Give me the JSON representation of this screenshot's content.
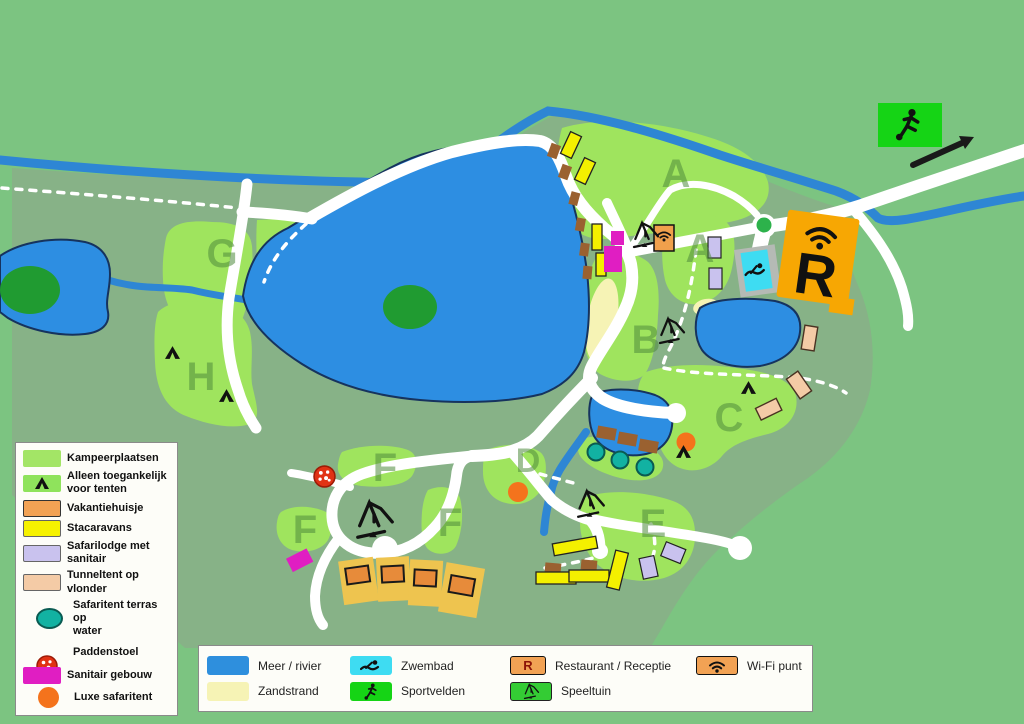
{
  "map": {
    "area_labels": [
      "G",
      "H",
      "A",
      "A",
      "B",
      "C",
      "D",
      "E",
      "F",
      "F",
      "F"
    ],
    "restaurant_label": "R"
  },
  "legend_left": {
    "items": [
      {
        "label": "Kampeerplaatsen",
        "swatch": "camp-green"
      },
      {
        "label": "Alleen toegankelijk\nvoor tenten",
        "swatch": "green-tent-icon"
      },
      {
        "label": "Vakantiehuisje",
        "swatch": "orange"
      },
      {
        "label": "Stacaravans",
        "swatch": "yellow"
      },
      {
        "label": "Safarilodge met\nsanitair",
        "swatch": "lavender"
      },
      {
        "label": "Tunneltent op vlonder",
        "swatch": "salmon"
      },
      {
        "label": "Safaritent terras op\nwater",
        "swatch": "teal-ellipse"
      },
      {
        "label": "Paddenstoel",
        "swatch": "red-dotted-circle"
      },
      {
        "label": "Sanitair gebouw",
        "swatch": "magenta"
      },
      {
        "label": "Luxe safaritent",
        "swatch": "orange-circle"
      }
    ]
  },
  "legend_bottom": {
    "restaurant_letter": "R",
    "items": [
      {
        "label": "Meer / rivier",
        "swatch": "blue"
      },
      {
        "label": "Zwembad",
        "swatch": "cyan-swimmer-icon"
      },
      {
        "label": "Restaurant / Receptie",
        "swatch": "orange-R"
      },
      {
        "label": "Wi-Fi punt",
        "swatch": "orange-wifi-icon"
      },
      {
        "label": "Zandstrand",
        "swatch": "pale-yellow"
      },
      {
        "label": "Sportvelden",
        "swatch": "green-soccer-icon"
      },
      {
        "label": "Speeltuin",
        "swatch": "green-playground-icon"
      }
    ]
  },
  "colors": {
    "background_green": "#7cc481",
    "park_green": "#87b287",
    "camp_green": "#9fe45e",
    "lake_blue": "#2d8ee2",
    "river_blue": "#2e86d4",
    "beach_yellow": "#f6f3b5",
    "road_white": "#ffffff",
    "restaurant_orange": "#f7a703",
    "pool_cyan": "#3edcf2",
    "sport_green": "#15d415",
    "stacaravan_yellow": "#f4f000",
    "safarilodge_purple": "#c9c2ee",
    "tunneltent_salmon": "#f4cba6",
    "sanitair_magenta": "#e01ec2",
    "vakantiehuisje_orange": "#f2a254",
    "luxe_safaritent_orange": "#f4731c",
    "safaritent_teal": "#12b2a2",
    "paddenstoel_red": "#e13214",
    "dock_brown": "#9a6130",
    "tree_green": "#209b31",
    "area_letter_green": "#4e8a3c"
  }
}
